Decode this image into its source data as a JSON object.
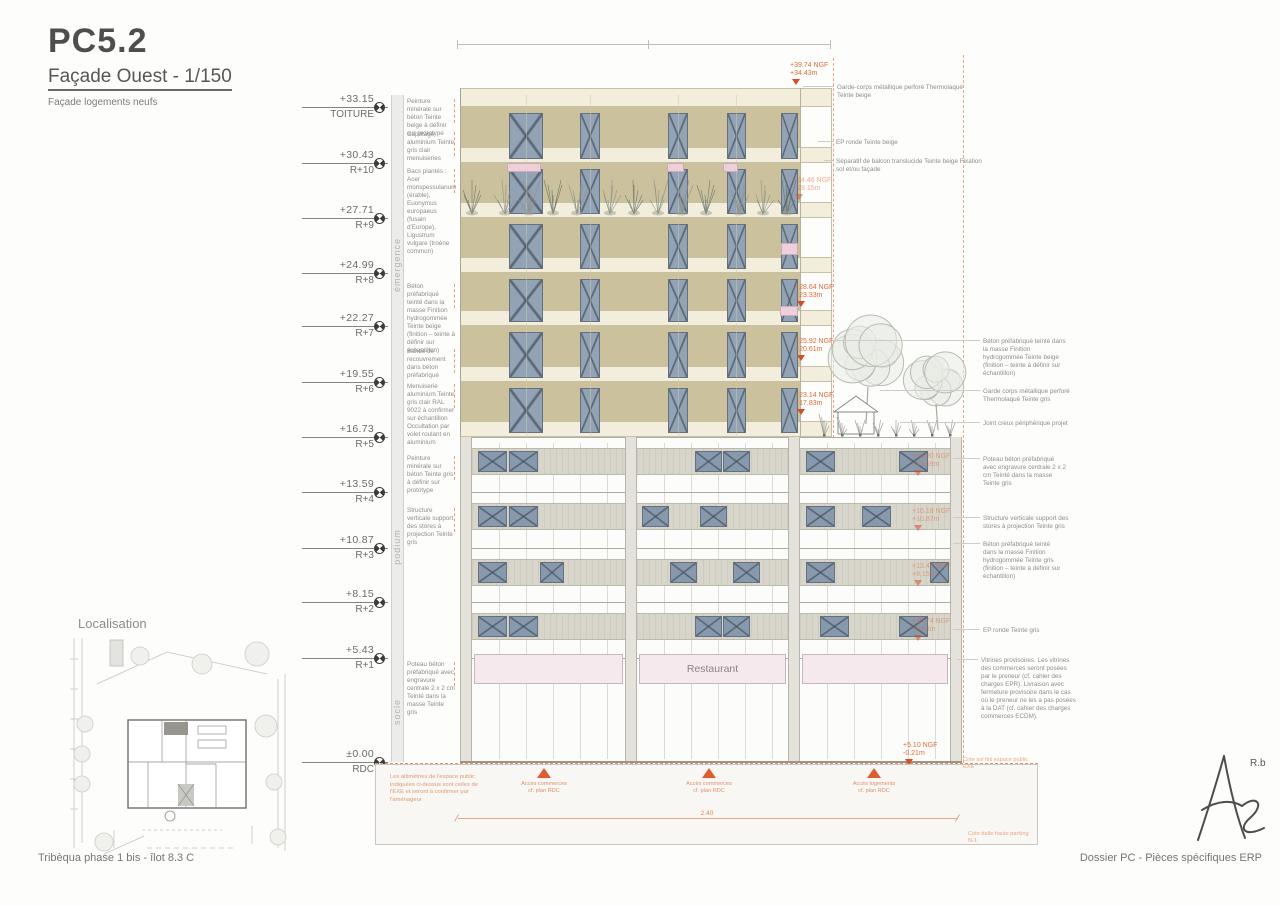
{
  "doc": {
    "code": "PC5.2",
    "subtitle": "Façade Ouest - 1/150",
    "caption": "Façade logements neufs",
    "localisation_title": "Localisation",
    "restaurant": "Restaurant",
    "signature_initials": "R.b",
    "footer_left": "Tribèqua phase 1 bis - îlot 8.3 C",
    "footer_right": "Dossier PC - Pièces spécifiques ERP"
  },
  "colors": {
    "annotation_orange": "#df6c3c",
    "marker_red": "#d64e26",
    "facade_beige": "#cbc29d",
    "slab_cream": "#f2eedb",
    "window_blue": "#92a3b6",
    "note_grey": "#8d8d89"
  },
  "zones": [
    {
      "label": "émergence",
      "y": 265
    },
    {
      "label": "podium",
      "y": 547
    },
    {
      "label": "socle",
      "y": 712
    }
  ],
  "levels": [
    {
      "value": "+33.15",
      "label": "TOITURE",
      "y": 107
    },
    {
      "value": "+30.43",
      "label": "R+10",
      "y": 163
    },
    {
      "value": "+27.71",
      "label": "R+9",
      "y": 218
    },
    {
      "value": "+24.99",
      "label": "R+8",
      "y": 273
    },
    {
      "value": "+22.27",
      "label": "R+7",
      "y": 326
    },
    {
      "value": "+19.55",
      "label": "R+6",
      "y": 382
    },
    {
      "value": "+16.73",
      "label": "R+5",
      "y": 437
    },
    {
      "value": "+13.59",
      "label": "R+4",
      "y": 492
    },
    {
      "value": "+10.87",
      "label": "R+3",
      "y": 548
    },
    {
      "value": "+8.15",
      "label": "R+2",
      "y": 602
    },
    {
      "value": "+5.43",
      "label": "R+1",
      "y": 658
    },
    {
      "value": "±0.00",
      "label": "RDC",
      "y": 762
    }
  ],
  "left_notes": [
    {
      "y": 98,
      "text": "Peinture minérale sur béton Teinte beige à définir sur prototype"
    },
    {
      "y": 131,
      "text": "Capotage aluminium Teinte gris clair menuiseries"
    },
    {
      "y": 168,
      "text": "Bacs plantés : Acer monspessulanum (érable), Euonymus europaeus (fusain d'Europe), Ligustrum vulgare (troène commun)"
    },
    {
      "y": 283,
      "text": "Béton préfabriqué teinté dans la masse Finition hydrogommée Teinte beige (finition – teinte à définir sur échantillon)"
    },
    {
      "y": 348,
      "text": "Bande de recouvrement dans béton préfabriqué"
    },
    {
      "y": 383,
      "text": "Menuiserie aluminium Teinte gris clair RAL 9022 à confirmer sur échantillon Occultation par volet roulant en aluminium"
    },
    {
      "y": 455,
      "text": "Peinture minérale sur béton Teinte gris à définir sur prototype"
    },
    {
      "y": 507,
      "text": "Structure verticale support des stores à projection Teinte gris"
    },
    {
      "y": 661,
      "text": "Poteau béton préfabriqué avec engravure centrale 2 x 2 cm Teinté dans la masse Teinte gris"
    }
  ],
  "right_notes": [
    {
      "x": 837,
      "y": 84,
      "w": 140,
      "lx": 803,
      "text": "Garde-corps métallique perforé Thermolaqué Teinte beige"
    },
    {
      "x": 836,
      "y": 139,
      "w": 100,
      "lx": 818,
      "text": "EP ronde Teinte beige"
    },
    {
      "x": 836,
      "y": 158,
      "w": 148,
      "lx": 824,
      "text": "Séparatif de balcon translucide Teinte beige Fixation sol et/ou façade"
    },
    {
      "x": 983,
      "y": 338,
      "w": 84,
      "lx": 833,
      "text": "Béton préfabriqué teinté dans la masse Finition hydrogommée Teinte beige (finition – teinte à définir sur échantillon)"
    },
    {
      "x": 983,
      "y": 388,
      "w": 88,
      "lx": 880,
      "text": "Garde corps métallique perforé Thermolaqué Teinte gris"
    },
    {
      "x": 983,
      "y": 420,
      "w": 92,
      "lx": 900,
      "text": "Joint creux périphérique projet"
    },
    {
      "x": 983,
      "y": 456,
      "w": 86,
      "lx": 953,
      "text": "Poteau béton préfabriqué avec engravure centrale 2 x 2 cm Teinté dans la masse Teinte gris"
    },
    {
      "x": 983,
      "y": 515,
      "w": 86,
      "lx": 953,
      "text": "Structure verticale support des stores à projection Teinte gris"
    },
    {
      "x": 983,
      "y": 541,
      "w": 82,
      "lx": 953,
      "text": "Béton préfabriqué teinté dans la masse Finition hydrogommée Teinte gris (finition – teinte à définir sur échantillon)"
    },
    {
      "x": 983,
      "y": 627,
      "w": 86,
      "lx": 953,
      "text": "EP ronde Teinte gris"
    },
    {
      "x": 981,
      "y": 657,
      "w": 96,
      "lx": 957,
      "text": "Vitrines provisoires. Les vitrines des commerces seront posées par le preneur (cf. cahier des charges EPR). Livraison avec fermeture provisoire dans le cas où le preneur ne les a pas posées à la DAT (cf. cahier des charges commerces ECDM)."
    }
  ],
  "ngf_markers": [
    {
      "l1": "+39.74 NGF",
      "l2": "+34.43m",
      "x": 790,
      "y": 62,
      "faint": false
    },
    {
      "l1": "+34.46 NGF",
      "l2": "+29.15m",
      "x": 793,
      "y": 177,
      "faint": true
    },
    {
      "l1": "+28.64 NGF",
      "l2": "+23.33m",
      "x": 795,
      "y": 284,
      "faint": false
    },
    {
      "l1": "+25.92 NGF",
      "l2": "+20.61m",
      "x": 795,
      "y": 338,
      "faint": false
    },
    {
      "l1": "+23.14 NGF",
      "l2": "+17.83m",
      "x": 795,
      "y": 392,
      "faint": false
    },
    {
      "l1": "+18.90 NGF",
      "l2": "+13.59m",
      "x": 912,
      "y": 453,
      "faint": true
    },
    {
      "l1": "+16.18 NGF",
      "l2": "+10.87m",
      "x": 912,
      "y": 508,
      "faint": true
    },
    {
      "l1": "+13.46 NGF",
      "l2": "+8.15m",
      "x": 912,
      "y": 563,
      "faint": true
    },
    {
      "l1": "+10.74 NGF",
      "l2": "+5.43m",
      "x": 912,
      "y": 618,
      "faint": true
    },
    {
      "l1": "+5.10 NGF",
      "l2": "-0.21m",
      "x": 903,
      "y": 742,
      "faint": false
    },
    {
      "l1": "+1.06 NGF",
      "l2": "-4.25m",
      "x": 802,
      "y": 818,
      "faint": false
    }
  ],
  "ground": {
    "note_left": "Les altimétries de l'espace public indiquées ci-dessus sont celles de l'EXE et seront à confirmer par l'aménageur",
    "dim": "2.40",
    "note_top_right": "Cote sol fini espace public EXE",
    "note_bottom_right": "Cote dalle haute parking N-1",
    "access_markers": [
      {
        "l1": "Accès commerces",
        "l2": "cf. plan RDC",
        "x": 544
      },
      {
        "l1": "Accès commerces",
        "l2": "cf. plan RDC",
        "x": 709
      },
      {
        "l1": "Accès logements",
        "l2": "cf. plan RDC",
        "x": 874
      }
    ]
  }
}
